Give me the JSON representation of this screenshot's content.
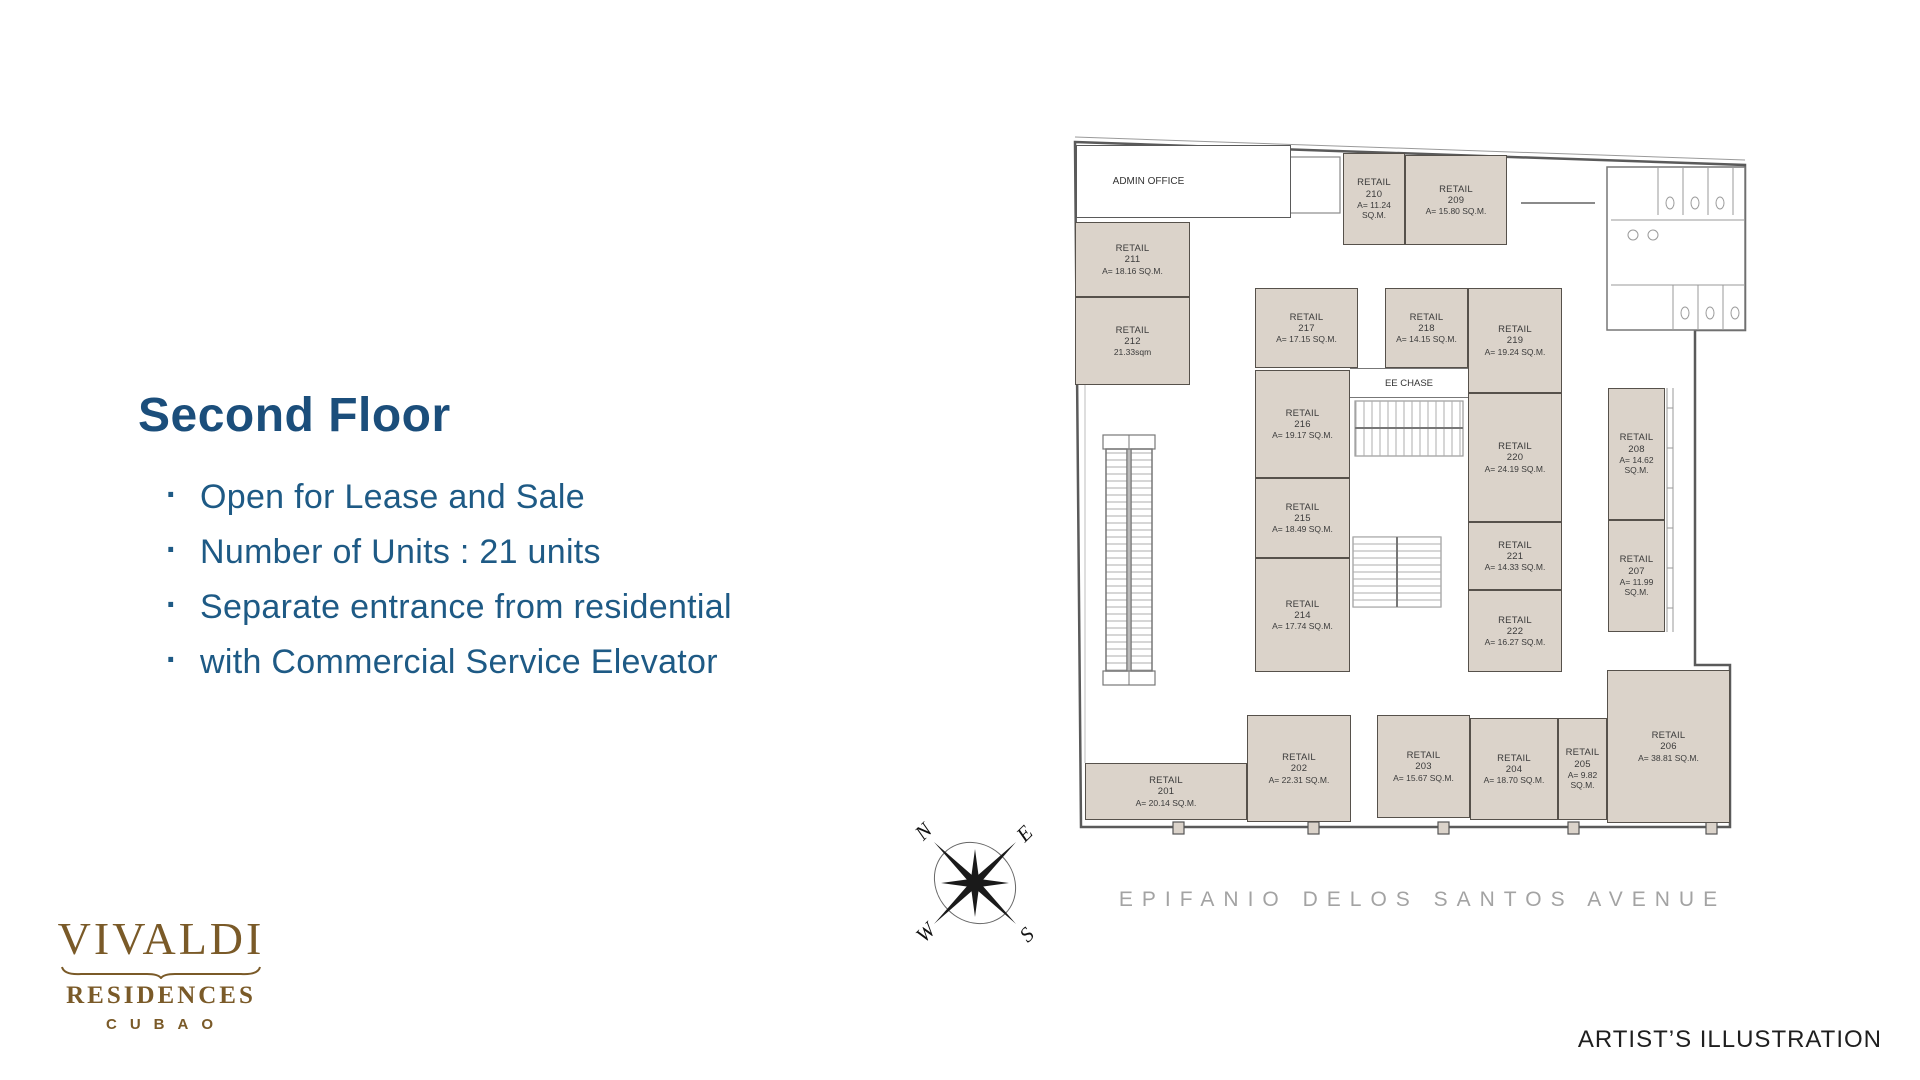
{
  "slide": {
    "title": "Second Floor",
    "bullets": [
      "Open for Lease and Sale",
      "Number of Units : 21 units",
      "Separate entrance from residential",
      "with Commercial Service Elevator"
    ],
    "artist_note": "ARTIST’S ILLUSTRATION",
    "title_color": "#1b4e7b",
    "bullet_color": "#1e5a85"
  },
  "logo": {
    "brand": "VIVALDI",
    "line2": "RESIDENCES",
    "line3": "CUBAO",
    "color": "#7a5a28"
  },
  "plan": {
    "admin_label": "ADMIN OFFICE",
    "ee_chase_label": "EE CHASE",
    "street_label": "EPIFANIO DELOS SANTOS AVENUE",
    "compass": {
      "n": "N",
      "e": "E",
      "s": "S",
      "w": "W"
    },
    "room_fill": "#dbd3ca",
    "wall_color": "#56514b",
    "units": [
      {
        "label": "RETAIL",
        "number": "201",
        "area": "A= 20.14 SQ.M.",
        "x": 12,
        "y": 628,
        "w": 162,
        "h": 57
      },
      {
        "label": "RETAIL",
        "number": "202",
        "area": "A= 22.31 SQ.M.",
        "x": 174,
        "y": 580,
        "w": 104,
        "h": 107
      },
      {
        "label": "RETAIL",
        "number": "203",
        "area": "A= 15.67 SQ.M.",
        "x": 304,
        "y": 580,
        "w": 93,
        "h": 103
      },
      {
        "label": "RETAIL",
        "number": "204",
        "area": "A= 18.70 SQ.M.",
        "x": 397,
        "y": 583,
        "w": 88,
        "h": 102
      },
      {
        "label": "RETAIL",
        "number": "205",
        "area": "A= 9.82 SQ.M.",
        "x": 485,
        "y": 583,
        "w": 49,
        "h": 102
      },
      {
        "label": "RETAIL",
        "number": "206",
        "area": "A= 38.81 SQ.M.",
        "x": 534,
        "y": 535,
        "w": 123,
        "h": 153
      },
      {
        "label": "RETAIL",
        "number": "207",
        "area": "A= 11.99 SQ.M.",
        "x": 535,
        "y": 385,
        "w": 57,
        "h": 112
      },
      {
        "label": "RETAIL",
        "number": "208",
        "area": "A= 14.62 SQ.M.",
        "x": 535,
        "y": 253,
        "w": 57,
        "h": 132
      },
      {
        "label": "RETAIL",
        "number": "209",
        "area": "A= 15.80 SQ.M.",
        "x": 332,
        "y": 20,
        "w": 102,
        "h": 90
      },
      {
        "label": "RETAIL",
        "number": "210",
        "area": "A= 11.24 SQ.M.",
        "x": 270,
        "y": 18,
        "w": 62,
        "h": 92
      },
      {
        "label": "RETAIL",
        "number": "211",
        "area": "A= 18.16 SQ.M.",
        "x": 2,
        "y": 87,
        "w": 115,
        "h": 75
      },
      {
        "label": "RETAIL",
        "number": "212",
        "area": "21.33sqm",
        "x": 2,
        "y": 162,
        "w": 115,
        "h": 88
      },
      {
        "label": "RETAIL",
        "number": "214",
        "area": "A= 17.74 SQ.M.",
        "x": 182,
        "y": 423,
        "w": 95,
        "h": 114
      },
      {
        "label": "RETAIL",
        "number": "215",
        "area": "A= 18.49 SQ.M.",
        "x": 182,
        "y": 343,
        "w": 95,
        "h": 80
      },
      {
        "label": "RETAIL",
        "number": "216",
        "area": "A= 19.17 SQ.M.",
        "x": 182,
        "y": 235,
        "w": 95,
        "h": 108
      },
      {
        "label": "RETAIL",
        "number": "217",
        "area": "A= 17.15 SQ.M.",
        "x": 182,
        "y": 153,
        "w": 103,
        "h": 80
      },
      {
        "label": "RETAIL",
        "number": "218",
        "area": "A= 14.15 SQ.M.",
        "x": 312,
        "y": 153,
        "w": 83,
        "h": 80
      },
      {
        "label": "RETAIL",
        "number": "219",
        "area": "A= 19.24 SQ.M.",
        "x": 395,
        "y": 153,
        "w": 94,
        "h": 105
      },
      {
        "label": "RETAIL",
        "number": "220",
        "area": "A= 24.19 SQ.M.",
        "x": 395,
        "y": 258,
        "w": 94,
        "h": 129
      },
      {
        "label": "RETAIL",
        "number": "221",
        "area": "A= 14.33 SQ.M.",
        "x": 395,
        "y": 387,
        "w": 94,
        "h": 68
      },
      {
        "label": "RETAIL",
        "number": "222",
        "area": "A= 16.27 SQ.M.",
        "x": 395,
        "y": 455,
        "w": 94,
        "h": 82
      }
    ]
  }
}
